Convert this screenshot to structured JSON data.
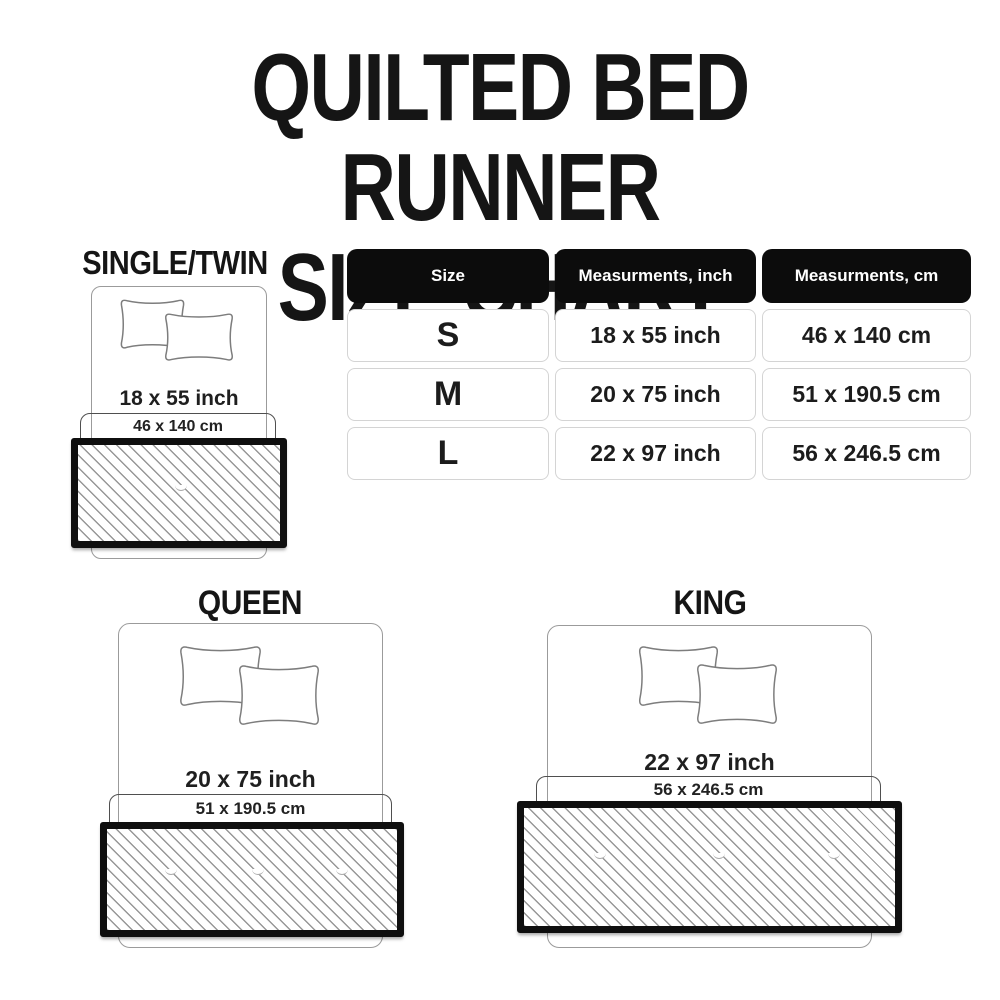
{
  "title": {
    "line1": "QUILTED BED RUNNER",
    "line2": "SIZE CHART"
  },
  "table": {
    "headers": [
      "Size",
      "Measurments, inch",
      "Measurments, cm"
    ],
    "rows": [
      {
        "size": "S",
        "inch": "18 x 55 inch",
        "cm": "46 x 140 cm"
      },
      {
        "size": "M",
        "inch": "20 x 75 inch",
        "cm": "51 x 190.5 cm"
      },
      {
        "size": "L",
        "inch": "22 x 97 inch",
        "cm": "56 x 246.5 cm"
      }
    ]
  },
  "diagrams": [
    {
      "label": "SINGLE/TWIN",
      "inch": "18 x 55 inch",
      "cm": "46 x 140 cm"
    },
    {
      "label": "QUEEN",
      "inch": "20 x 75 inch",
      "cm": "51 x 190.5 cm"
    },
    {
      "label": "KING",
      "inch": "22 x 97 inch",
      "cm": "56 x 246.5 cm"
    }
  ],
  "colors": {
    "background": "#ffffff",
    "text": "#1a1a1a",
    "table_header_bg": "#0c0c0c",
    "table_header_text": "#ffffff",
    "cell_border": "#d4d4d4",
    "bed_outline": "#9b9b9b",
    "bracket_outline": "#4f4f4f",
    "runner_border": "#0f0f0f",
    "hatch_line": "#979797"
  }
}
